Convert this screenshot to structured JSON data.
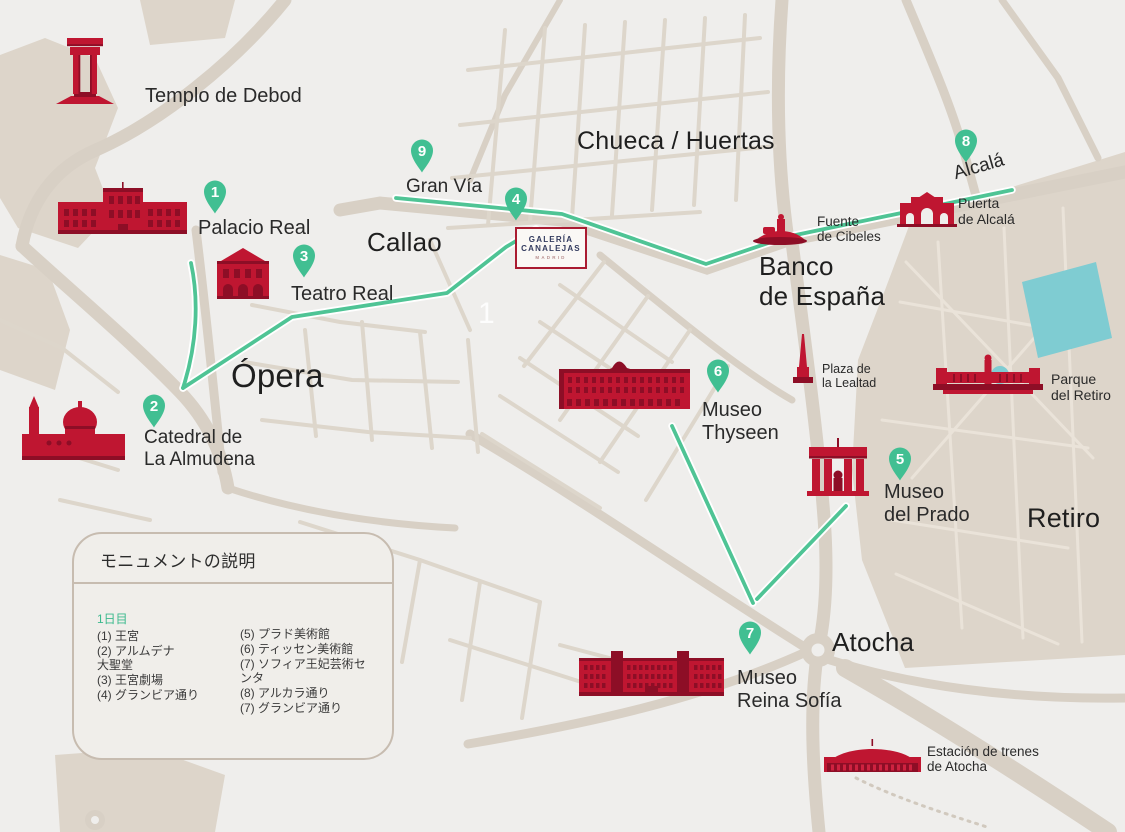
{
  "map_title": "Madrid monuments walking map",
  "colors": {
    "background": "#efeeec",
    "road": "#d8d0c5",
    "road_minor": "#ddd6cb",
    "park": "#ddd5ca",
    "park_path": "#eae3d9",
    "water": "#7fccd2",
    "monument_red": "#bf1631",
    "monument_red_dark": "#8d0e26",
    "marker_green": "#41bf92",
    "route_green": "#4fc495",
    "label_dark": "#2a2a2a",
    "legend_border": "#c7bcb0",
    "canalejas_border": "#aa1b31",
    "canalejas_text": "#323a5e"
  },
  "markers": [
    {
      "number": "1"
    },
    {
      "number": "2"
    },
    {
      "number": "3"
    },
    {
      "number": "4"
    },
    {
      "number": "5"
    },
    {
      "number": "6"
    },
    {
      "number": "7"
    },
    {
      "number": "8"
    },
    {
      "number": "9"
    }
  ],
  "labels": {
    "templo_debod": "Templo de Debod",
    "palacio_real": "Palacio Real",
    "teatro_real": "Teatro Real",
    "catedral": "Catedral de\nLa Almudena",
    "opera": "Ópera",
    "callao": "Callao",
    "gran_via": "Gran Vía",
    "chueca": "Chueca / Huertas",
    "banco": "Banco\nde España",
    "cibeles": "Fuente\nde Cibeles",
    "alcala_street": "Alcalá",
    "puerta_alcala": "Puerta\nde Alcalá",
    "plaza_lealtad": "Plaza de\nla Lealtad",
    "parque_retiro": "Parque\ndel Retiro",
    "museo_thyseen": "Museo\nThyseen",
    "museo_prado": "Museo\ndel Prado",
    "retiro": "Retiro",
    "museo_reina_sofia": "Museo\nReina Sofía",
    "atocha": "Atocha",
    "estacion_atocha": "Estación de trenes\nde Atocha",
    "plaza_number": "1"
  },
  "canalejas_logo": {
    "line1": "GALERÍA",
    "line2": "CANALEJAS",
    "line3": "MADRID"
  },
  "legend": {
    "title": "モニュメントの説明",
    "day": "1日目",
    "left_items": [
      "(1) 王宮",
      "(2) アルムデナ\n大聖堂",
      "(3) 王宮劇場",
      "(4) グランビア通り"
    ],
    "right_items": [
      "(5) プラド美術館",
      "(6) ティッセン美術館",
      "(7) ソフィア王妃芸術センタ",
      "(8) アルカラ通り",
      "(7) グランビア通り"
    ]
  }
}
